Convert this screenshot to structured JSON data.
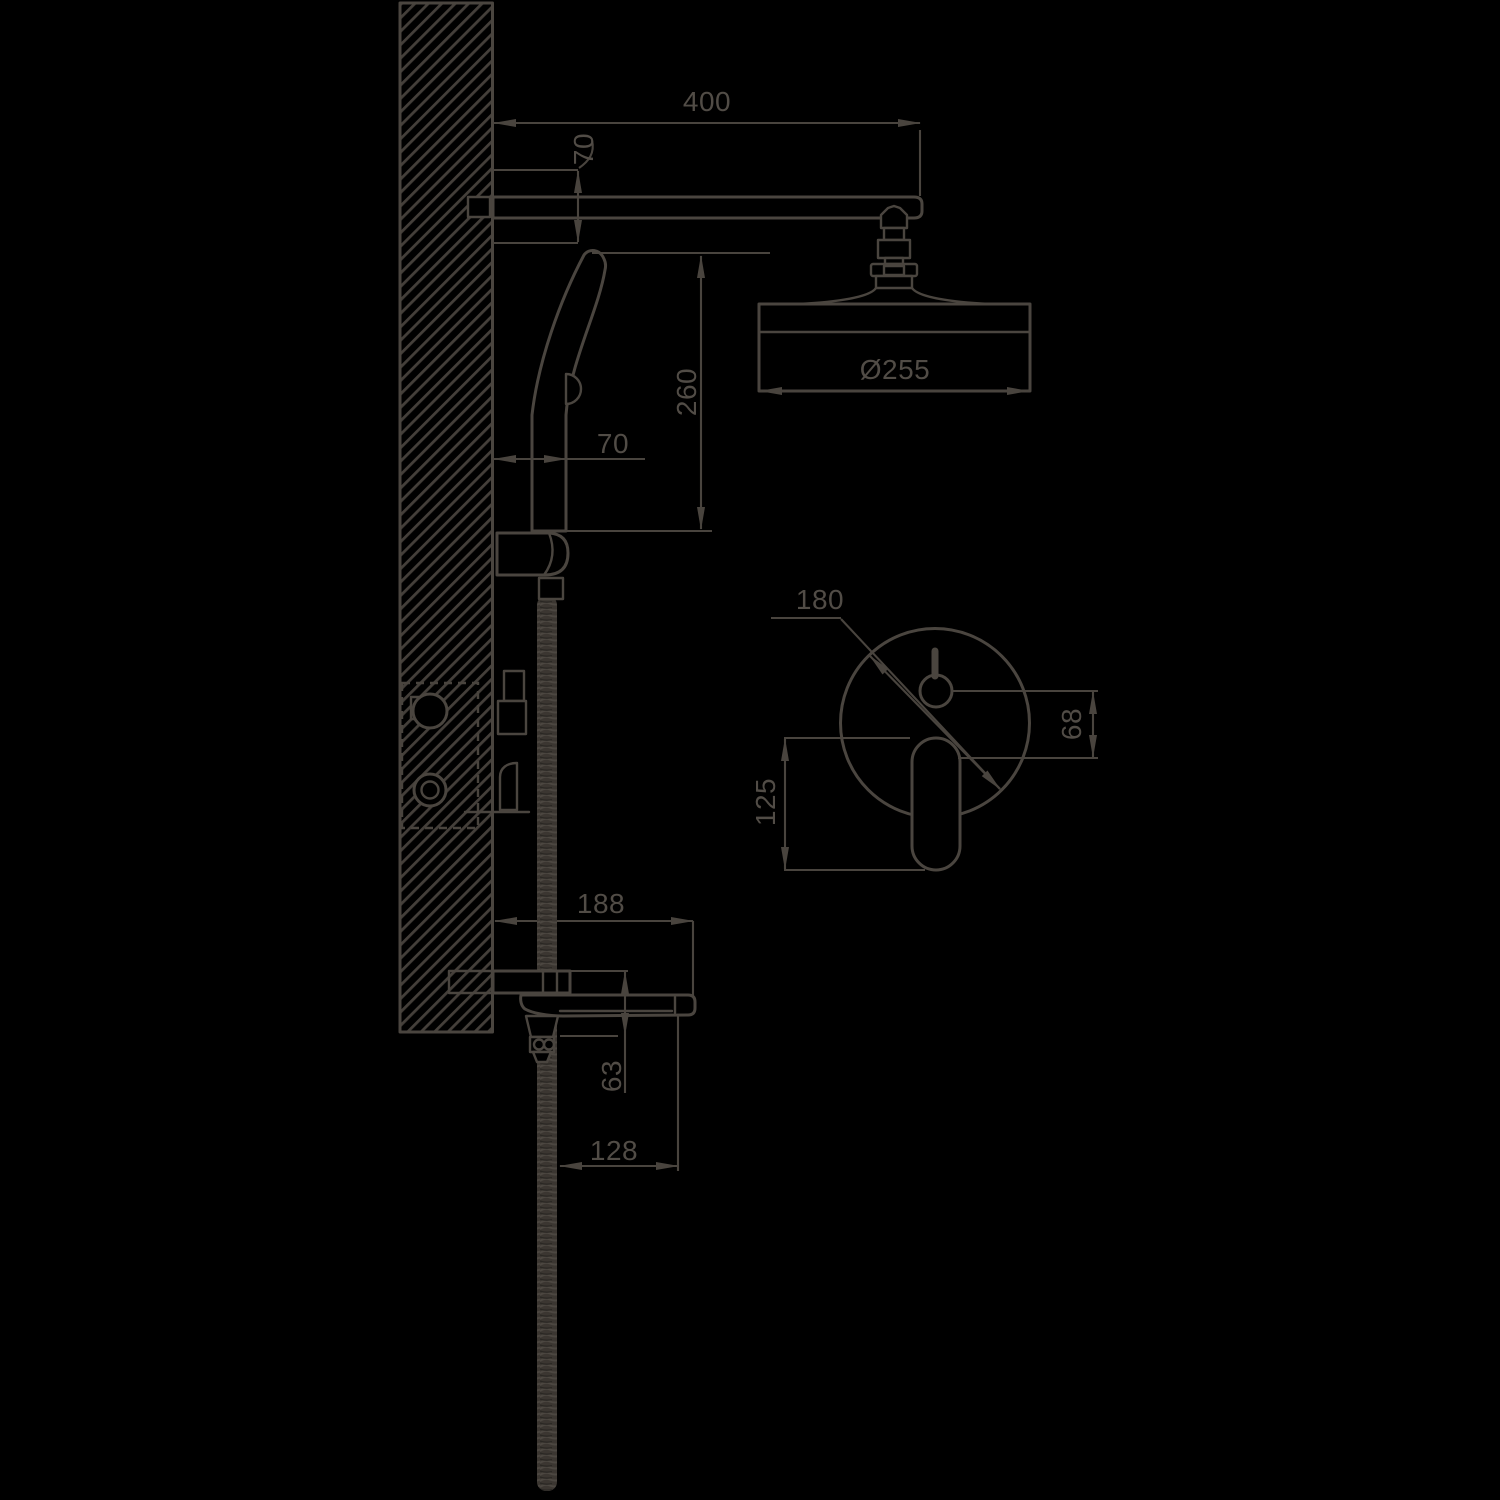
{
  "drawing": {
    "colors": {
      "background": "#000000",
      "line": "#4a453f"
    },
    "dimensions": {
      "arm_length": "400",
      "arm_drop": "70",
      "hand_shower_offset": "70",
      "hand_shower_height": "260",
      "head_diameter": "Ø255",
      "plate_diameter": "180",
      "knob_lever_gap": "68",
      "lever_length": "125",
      "spout_projection": "188",
      "spout_drop": "63",
      "hose_reach": "128"
    }
  }
}
